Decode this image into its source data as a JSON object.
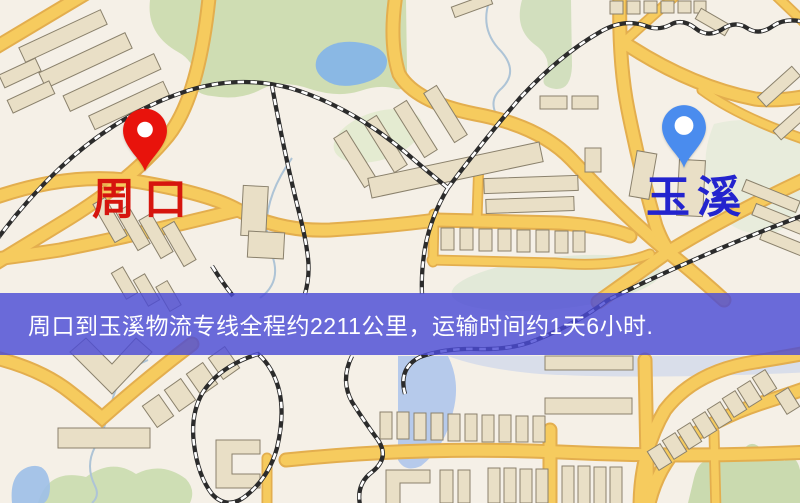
{
  "banner": {
    "text": "周口到玉溪物流专线全程约2211公里，运输时间约1天6小时.",
    "background_color": "#4c4cd6",
    "text_color": "#ffffff"
  },
  "markers": {
    "origin": {
      "label": "周口",
      "pin_color": "#e8130c",
      "label_color": "#d6150e"
    },
    "destination": {
      "label": "玉溪",
      "pin_color": "#4a8cee",
      "label_color": "#2324ce"
    }
  },
  "route_info": {
    "origin": "周口",
    "destination": "玉溪",
    "service": "物流专线",
    "distance_text": "约2211公里",
    "duration_text": "约1天6小时"
  },
  "map_palette": {
    "background": "#f5f0e7",
    "road_fill": "#f6cb5e",
    "road_casing": "#e3ae4e",
    "railway_dark": "#2b2b2b",
    "railway_light": "#ffffff",
    "park_green": "#ccdbb0",
    "water_blue": "#86b5e7",
    "building_tan": "#e9dfc6",
    "building_outline": "#8a816c"
  }
}
